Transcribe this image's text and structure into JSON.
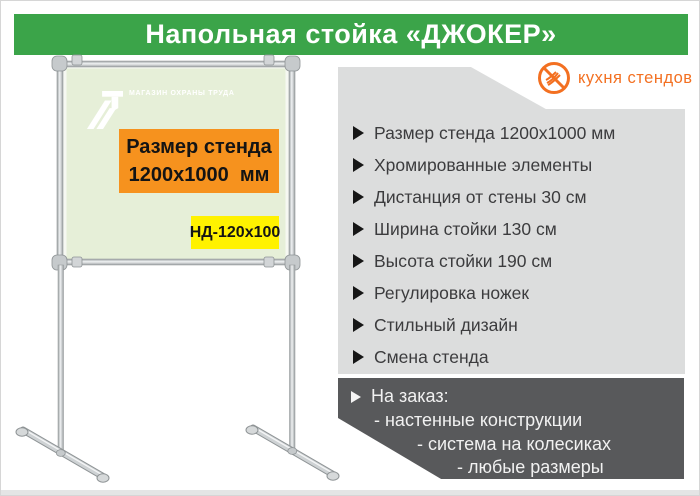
{
  "header": {
    "title": "Напольная стойка «ДЖОКЕР»"
  },
  "brand": {
    "name": "кухня стендов",
    "icon": "crossed-whisk-icon"
  },
  "stand": {
    "vendor_logo_text": "МАГАЗИН ОХРАНЫ ТРУДА",
    "size_label_line1": "Размер стенда",
    "size_label_line2": "1200х1000  мм",
    "model_code": "НД-120х100"
  },
  "features": {
    "items": [
      "Размер стенда 1200х1000 мм",
      "Хромированные элементы",
      "Дистанция от стены 30 см",
      "Ширина стойки 130 см",
      "Высота стойки 190 см",
      "Регулировка ножек",
      "Стильный дизайн",
      "Смена стенда"
    ]
  },
  "custom_order": {
    "title": "На заказ:",
    "items": [
      "- настенные конструкции",
      "- система на колесиках",
      "- любые размеры"
    ]
  },
  "colors": {
    "green": "#3BA449",
    "orange": "#F6921E",
    "yellow": "#FFF200",
    "brandOrange": "#F37021",
    "panelGray": "#DCDDDD",
    "darkGray": "#58595B",
    "boardGreen": "#E6EFD8"
  }
}
